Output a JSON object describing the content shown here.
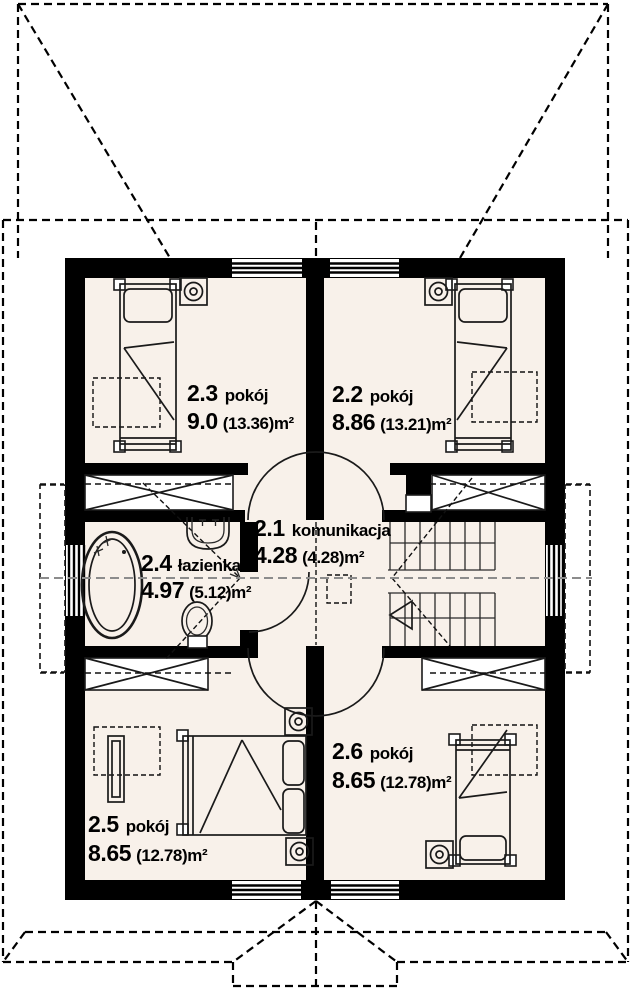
{
  "plan": {
    "rooms": [
      {
        "number": "2.1",
        "name": "komunikacja",
        "area": "4.28",
        "area_gross": "(4.28)m²"
      },
      {
        "number": "2.2",
        "name": "pokój",
        "area": "8.86",
        "area_gross": "(13.21)m²"
      },
      {
        "number": "2.3",
        "name": "pokój",
        "area": "9.0",
        "area_gross": "(13.36)m²"
      },
      {
        "number": "2.4",
        "name": "łazienka",
        "area": "4.97",
        "area_gross": "(5.12)m²"
      },
      {
        "number": "2.5",
        "name": "pokój",
        "area": "8.65",
        "area_gross": "(12.78)m²"
      },
      {
        "number": "2.6",
        "name": "pokój",
        "area": "8.65",
        "area_gross": "(12.78)m²"
      }
    ],
    "colors": {
      "wall": "#000000",
      "floor": "#f8f1ea",
      "paper": "#ffffff",
      "roofline_gray": "#8c8c8c"
    }
  }
}
